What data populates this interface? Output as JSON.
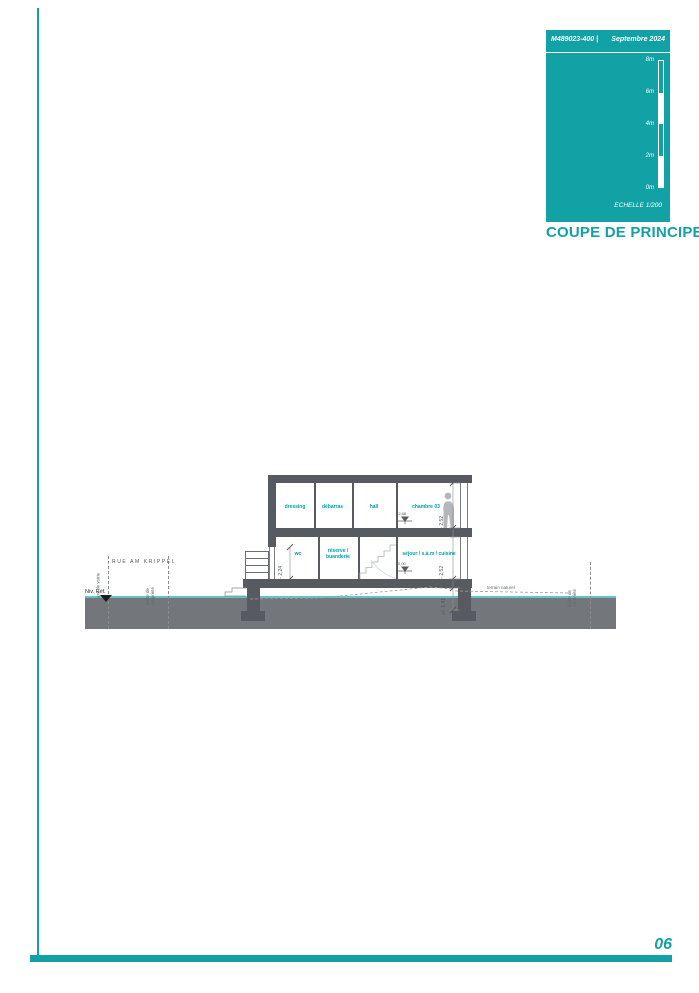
{
  "colors": {
    "accent": "#12a1a4",
    "wall_gray": "#575b61",
    "ground_gray": "#73767a",
    "terrain_cyan": "#62c4c6",
    "room_label_teal": "#00a0a6"
  },
  "page": {
    "number": "06"
  },
  "title_block": {
    "ref": "M489023-400 |",
    "date": "Septembre 2024",
    "scale_label": "ECHELLE  1/200",
    "title": "COUPE DE PRINCIPE",
    "scale_ticks": [
      "8m",
      "6m",
      "4m",
      "2m",
      "0m"
    ]
  },
  "drawing": {
    "street": "RUE AM KRIPPEL",
    "ref_level": "Niv. Réf.",
    "road_axis": "axe de voirie",
    "property_limit_l1": "limite de",
    "property_limit_l2": "propriété",
    "terrain": "terrain naturel",
    "levels": {
      "upper": "+2,88",
      "ground": "0,00"
    },
    "dims": {
      "upper": "+/- 2,52",
      "ground_floor": "+/- 2,52",
      "base": "+/- 1,41",
      "entrance": "+/- 2,24"
    },
    "rooms": {
      "upper": [
        "dressing",
        "débarras",
        "hall",
        "chambre 03"
      ],
      "ground_wc": "wc",
      "ground_reserve_l1": "réserve /",
      "ground_reserve_l2": "buanderie",
      "ground_sejour": "séjour / s.à.m / cuisine"
    }
  }
}
